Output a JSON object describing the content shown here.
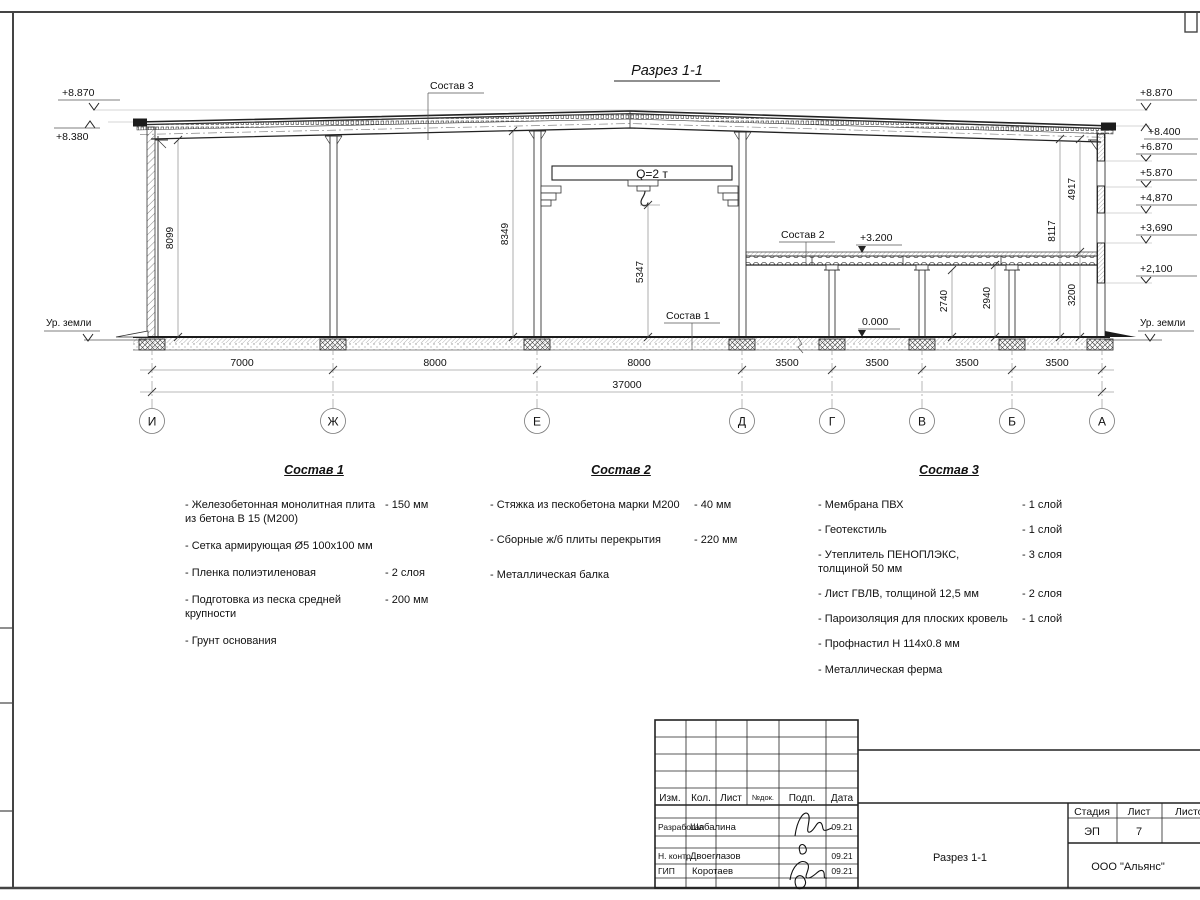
{
  "sheet": {
    "title": "Разрез 1-1",
    "crane_capacity": "Q=2 т",
    "ground_level_label": "Ур. земли",
    "levels": {
      "mezzanine": "+3.200",
      "zero": "0.000"
    },
    "elevations_left": [
      "+8.870",
      "+8.380"
    ],
    "elevations_right": [
      "+8.870",
      "+8.400",
      "+6.870",
      "+5.870",
      "+4,870",
      "+3,690",
      "+2,100"
    ],
    "axes": [
      "И",
      "Ж",
      "Е",
      "Д",
      "Г",
      "В",
      "Б",
      "А"
    ],
    "dims": {
      "spans": [
        "7000",
        "8000",
        "8000",
        "3500",
        "3500",
        "3500",
        "3500"
      ],
      "total": "37000",
      "vertical": {
        "left_wall": "8099",
        "mid_col": "8349",
        "hook": "5347",
        "beam": "2740",
        "slab": "2940",
        "mezz": "3200",
        "right_total": "8117",
        "right_upper": "4917"
      }
    }
  },
  "leaders": {
    "c1": "Состав 1",
    "c2": "Состав 2",
    "c3": "Состав 3"
  },
  "compositions": [
    {
      "title": "Состав 1",
      "items": [
        {
          "text": "- Железобетонная  монолитная плита\nиз бетона В 15 (М200)",
          "value": "- 150 мм"
        },
        {
          "text": "- Сетка армирующая Ø5 100x100 мм",
          "value": ""
        },
        {
          "text": "- Пленка полиэтиленовая",
          "value": "- 2 слоя"
        },
        {
          "text": "- Подготовка из песка средней\nкрупности",
          "value": "- 200 мм"
        },
        {
          "text": "- Грунт основания",
          "value": ""
        }
      ]
    },
    {
      "title": "Состав 2",
      "items": [
        {
          "text": "- Стяжка из пескобетона марки М200",
          "value": "- 40 мм"
        },
        {
          "text": "- Сборные ж/б плиты перекрытия",
          "value": "- 220 мм"
        },
        {
          "text": "- Металлическая балка",
          "value": ""
        }
      ]
    },
    {
      "title": "Состав 3",
      "items": [
        {
          "text": "- Мембрана ПВХ",
          "value": "- 1 слой"
        },
        {
          "text": "- Геотекстиль",
          "value": "- 1 слой"
        },
        {
          "text": "- Утеплитель ПЕНОПЛЭКС,\nтолщиной 50 мм",
          "value": "- 3 слоя"
        },
        {
          "text": "- Лист ГВЛВ, толщиной 12,5 мм",
          "value": "- 2 слоя"
        },
        {
          "text": "- Пароизоляция для плоских кровель",
          "value": "- 1 слой"
        },
        {
          "text": "- Профнастил Н 114x0.8 мм",
          "value": ""
        },
        {
          "text": "- Металлическая ферма",
          "value": ""
        }
      ]
    }
  ],
  "titleblock": {
    "cols": [
      "Изм.",
      "Кол.",
      "Лист",
      "№док.",
      "Подп.",
      "Дата"
    ],
    "rows": [
      {
        "role": "Разработал",
        "name": "Шабалина",
        "date": "09.21"
      },
      {
        "role": "Н. контр.",
        "name": "Двоеглазов",
        "date": "09.21"
      },
      {
        "role": "ГИП",
        "name": "Коротаев",
        "date": "09.21"
      }
    ],
    "stage_label": "Стадия",
    "sheet_label": "Лист",
    "sheets_label": "Листов",
    "stage": "ЭП",
    "sheet_no": "7",
    "doc_title": "Разрез 1-1",
    "company": "ООО \"Альянс\""
  }
}
